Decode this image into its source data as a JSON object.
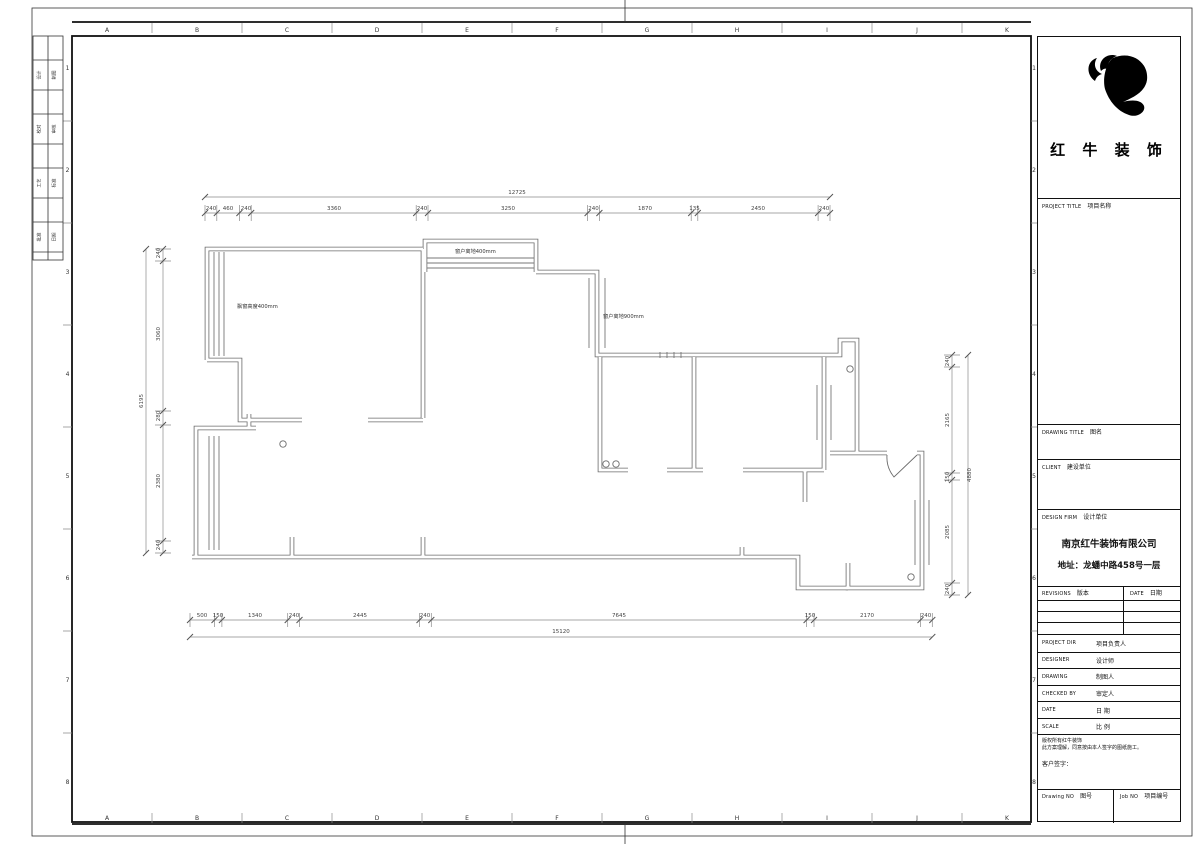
{
  "sheet": {
    "grid_letters": [
      "A",
      "B",
      "C",
      "D",
      "E",
      "F",
      "G",
      "H",
      "I",
      "J",
      "K"
    ],
    "grid_numbers": [
      "1",
      "2",
      "3",
      "4",
      "5",
      "6",
      "7",
      "8"
    ],
    "signoff_cells": [
      "设计",
      "制图",
      "校对",
      "审核",
      "工艺",
      "标准",
      "批准",
      "日期"
    ]
  },
  "titleblock": {
    "company_display": "红 牛 装 饰",
    "sections": {
      "project_title_en": "PROJECT TITLE",
      "project_title_zh": "项目名称",
      "drawing_title_en": "DRAWING TITLE",
      "drawing_title_zh": "图名",
      "client_en": "CLIENT",
      "client_zh": "建设单位",
      "design_firm_en": "DESIGN FIRM",
      "design_firm_zh": "设计单位"
    },
    "firm_name": "南京红牛装饰有限公司",
    "firm_address": "地址：龙蟠中路458号一层",
    "revisions_en": "REVISIONS",
    "revisions_zh": "版本",
    "date_en": "DATE",
    "date_zh": "日期",
    "rows": [
      {
        "en": "PROJECT DIR",
        "zh": "项目负责人"
      },
      {
        "en": "DESIGNER",
        "zh": "设计师"
      },
      {
        "en": "DRAWING",
        "zh": "制图人"
      },
      {
        "en": "CHECKED BY",
        "zh": "审定人"
      },
      {
        "en": "DATE",
        "zh": "日 期"
      },
      {
        "en": "SCALE",
        "zh": "比 例"
      }
    ],
    "copyright_line1": "版权所有红牛装饰",
    "copyright_line2": "此方案理解，同意按由本人签字的图纸施工。",
    "client_sign_label": "客户签字：",
    "drawing_no_en": "Drawing NO",
    "drawing_no_zh": "图号",
    "job_no_en": "Job NO",
    "job_no_zh": "项目编号"
  },
  "plan": {
    "annotations": [
      "飘窗高度400mm",
      "窗户离地400mm",
      "窗户离地900mm"
    ],
    "dimensions": {
      "top": {
        "total": "12725",
        "segments": [
          "240",
          "460",
          "240",
          "3360",
          "240",
          "3250",
          "240",
          "1870",
          "135",
          "2450",
          "240"
        ]
      },
      "bottom": {
        "total": "15120",
        "segments": [
          "500",
          "150",
          "1340",
          "240",
          "2445",
          "240",
          "7645",
          "150",
          "2170",
          "240"
        ]
      },
      "left": {
        "total": "6195",
        "segments": [
          "240",
          "3060",
          "280",
          "2380",
          "240"
        ]
      },
      "right": {
        "total": "4880",
        "segments": [
          "240",
          "2165",
          "150",
          "2085",
          "240"
        ]
      }
    }
  }
}
